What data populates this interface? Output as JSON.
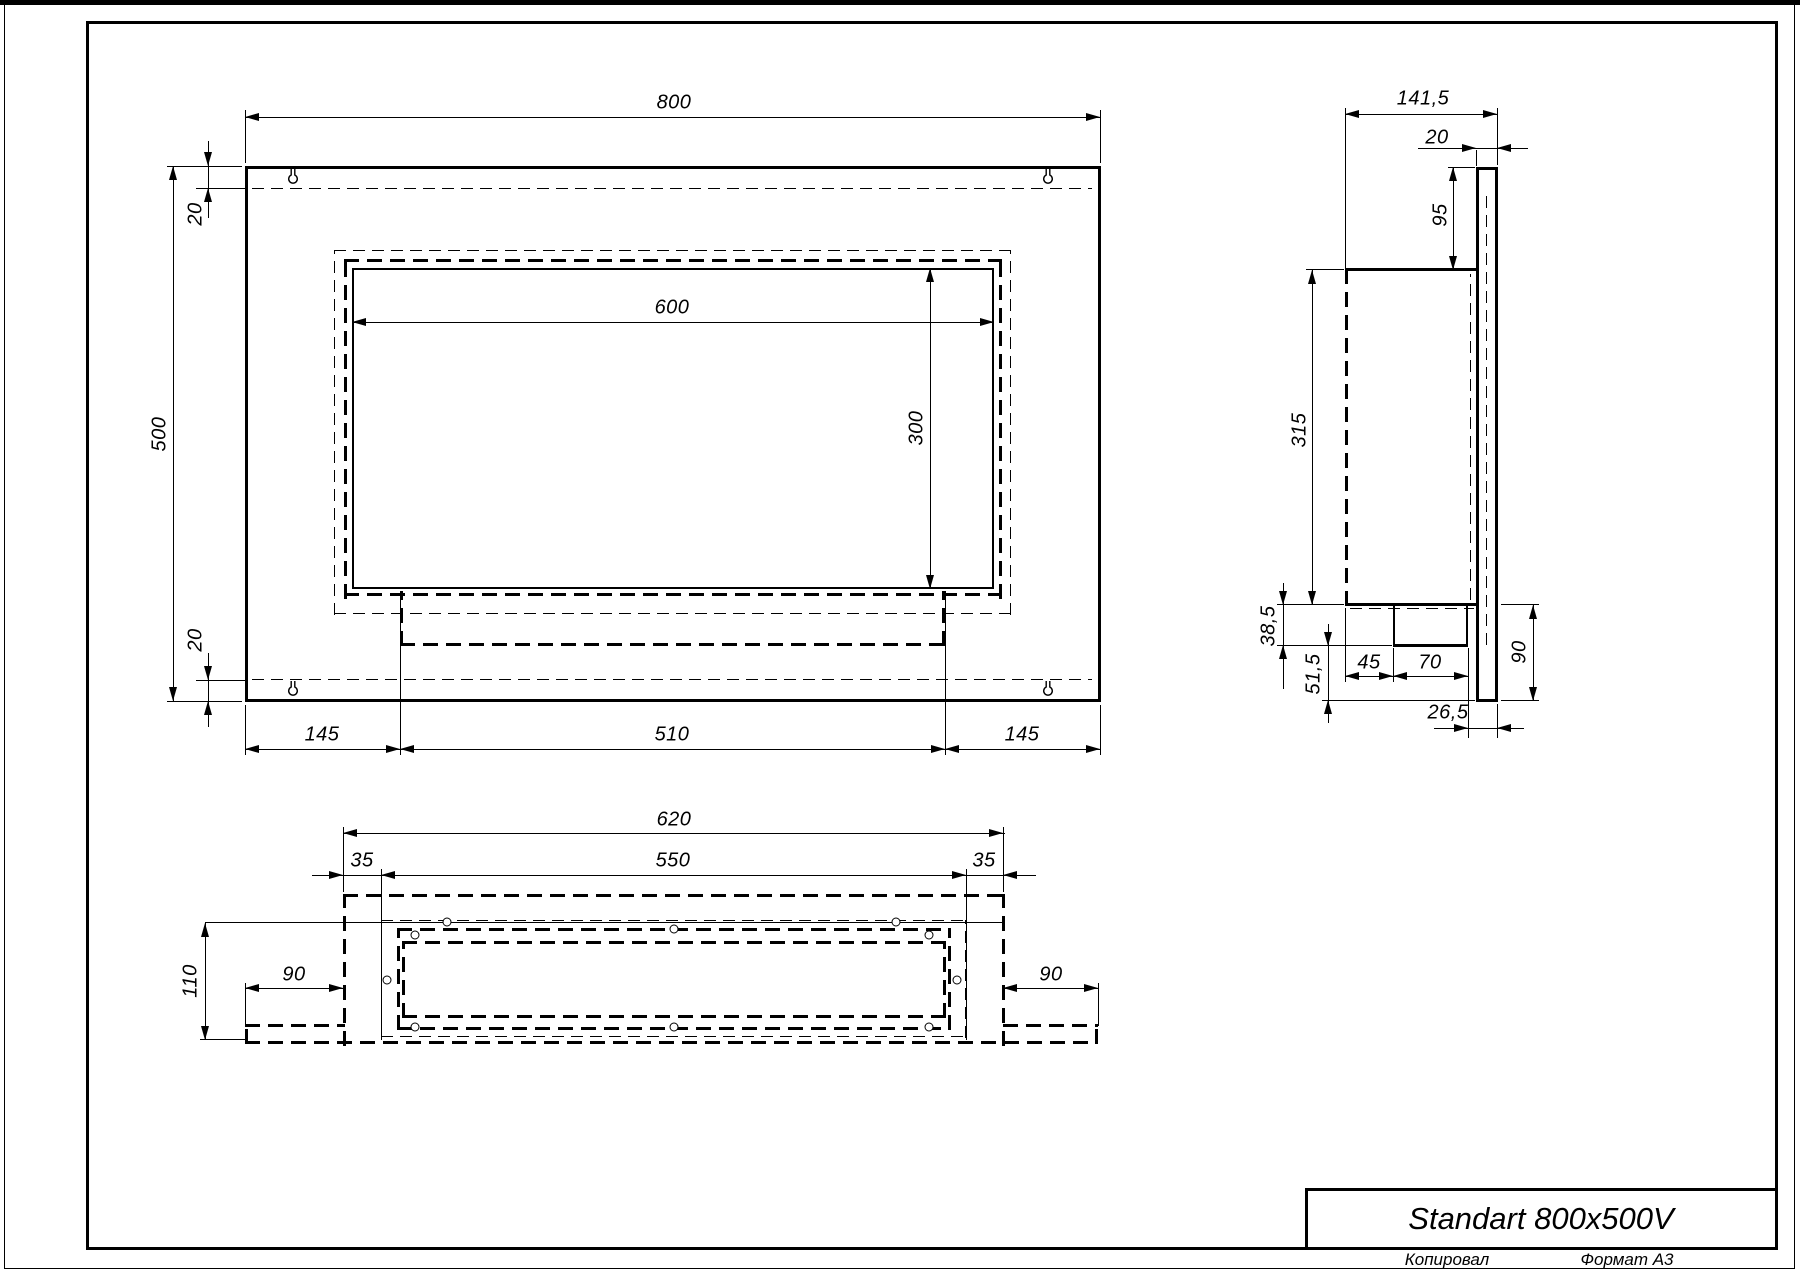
{
  "sheet": {
    "title": "Standart 800x500V",
    "footer_copied": "Копировал",
    "footer_format": "Формат А3"
  },
  "front_view": {
    "width": "800",
    "height": "500",
    "top_inset": "20",
    "bottom_inset": "20",
    "opening_width": "600",
    "opening_height": "300",
    "left_margin": "145",
    "tray_width": "510",
    "right_margin": "145"
  },
  "side_view": {
    "total_depth": "141,5",
    "plate_thickness": "20",
    "top_drop": "95",
    "body_height": "315",
    "tray_drop": "38,5",
    "lower_gap": "51,5",
    "tray_offset": "45",
    "tray_depth": "70",
    "rear_gap": "26,5",
    "plate_drop": "90"
  },
  "bottom_view": {
    "body_width": "620",
    "inner_width": "550",
    "left_inset": "35",
    "right_inset": "35",
    "depth": "110",
    "left_wing": "90",
    "right_wing": "90"
  }
}
